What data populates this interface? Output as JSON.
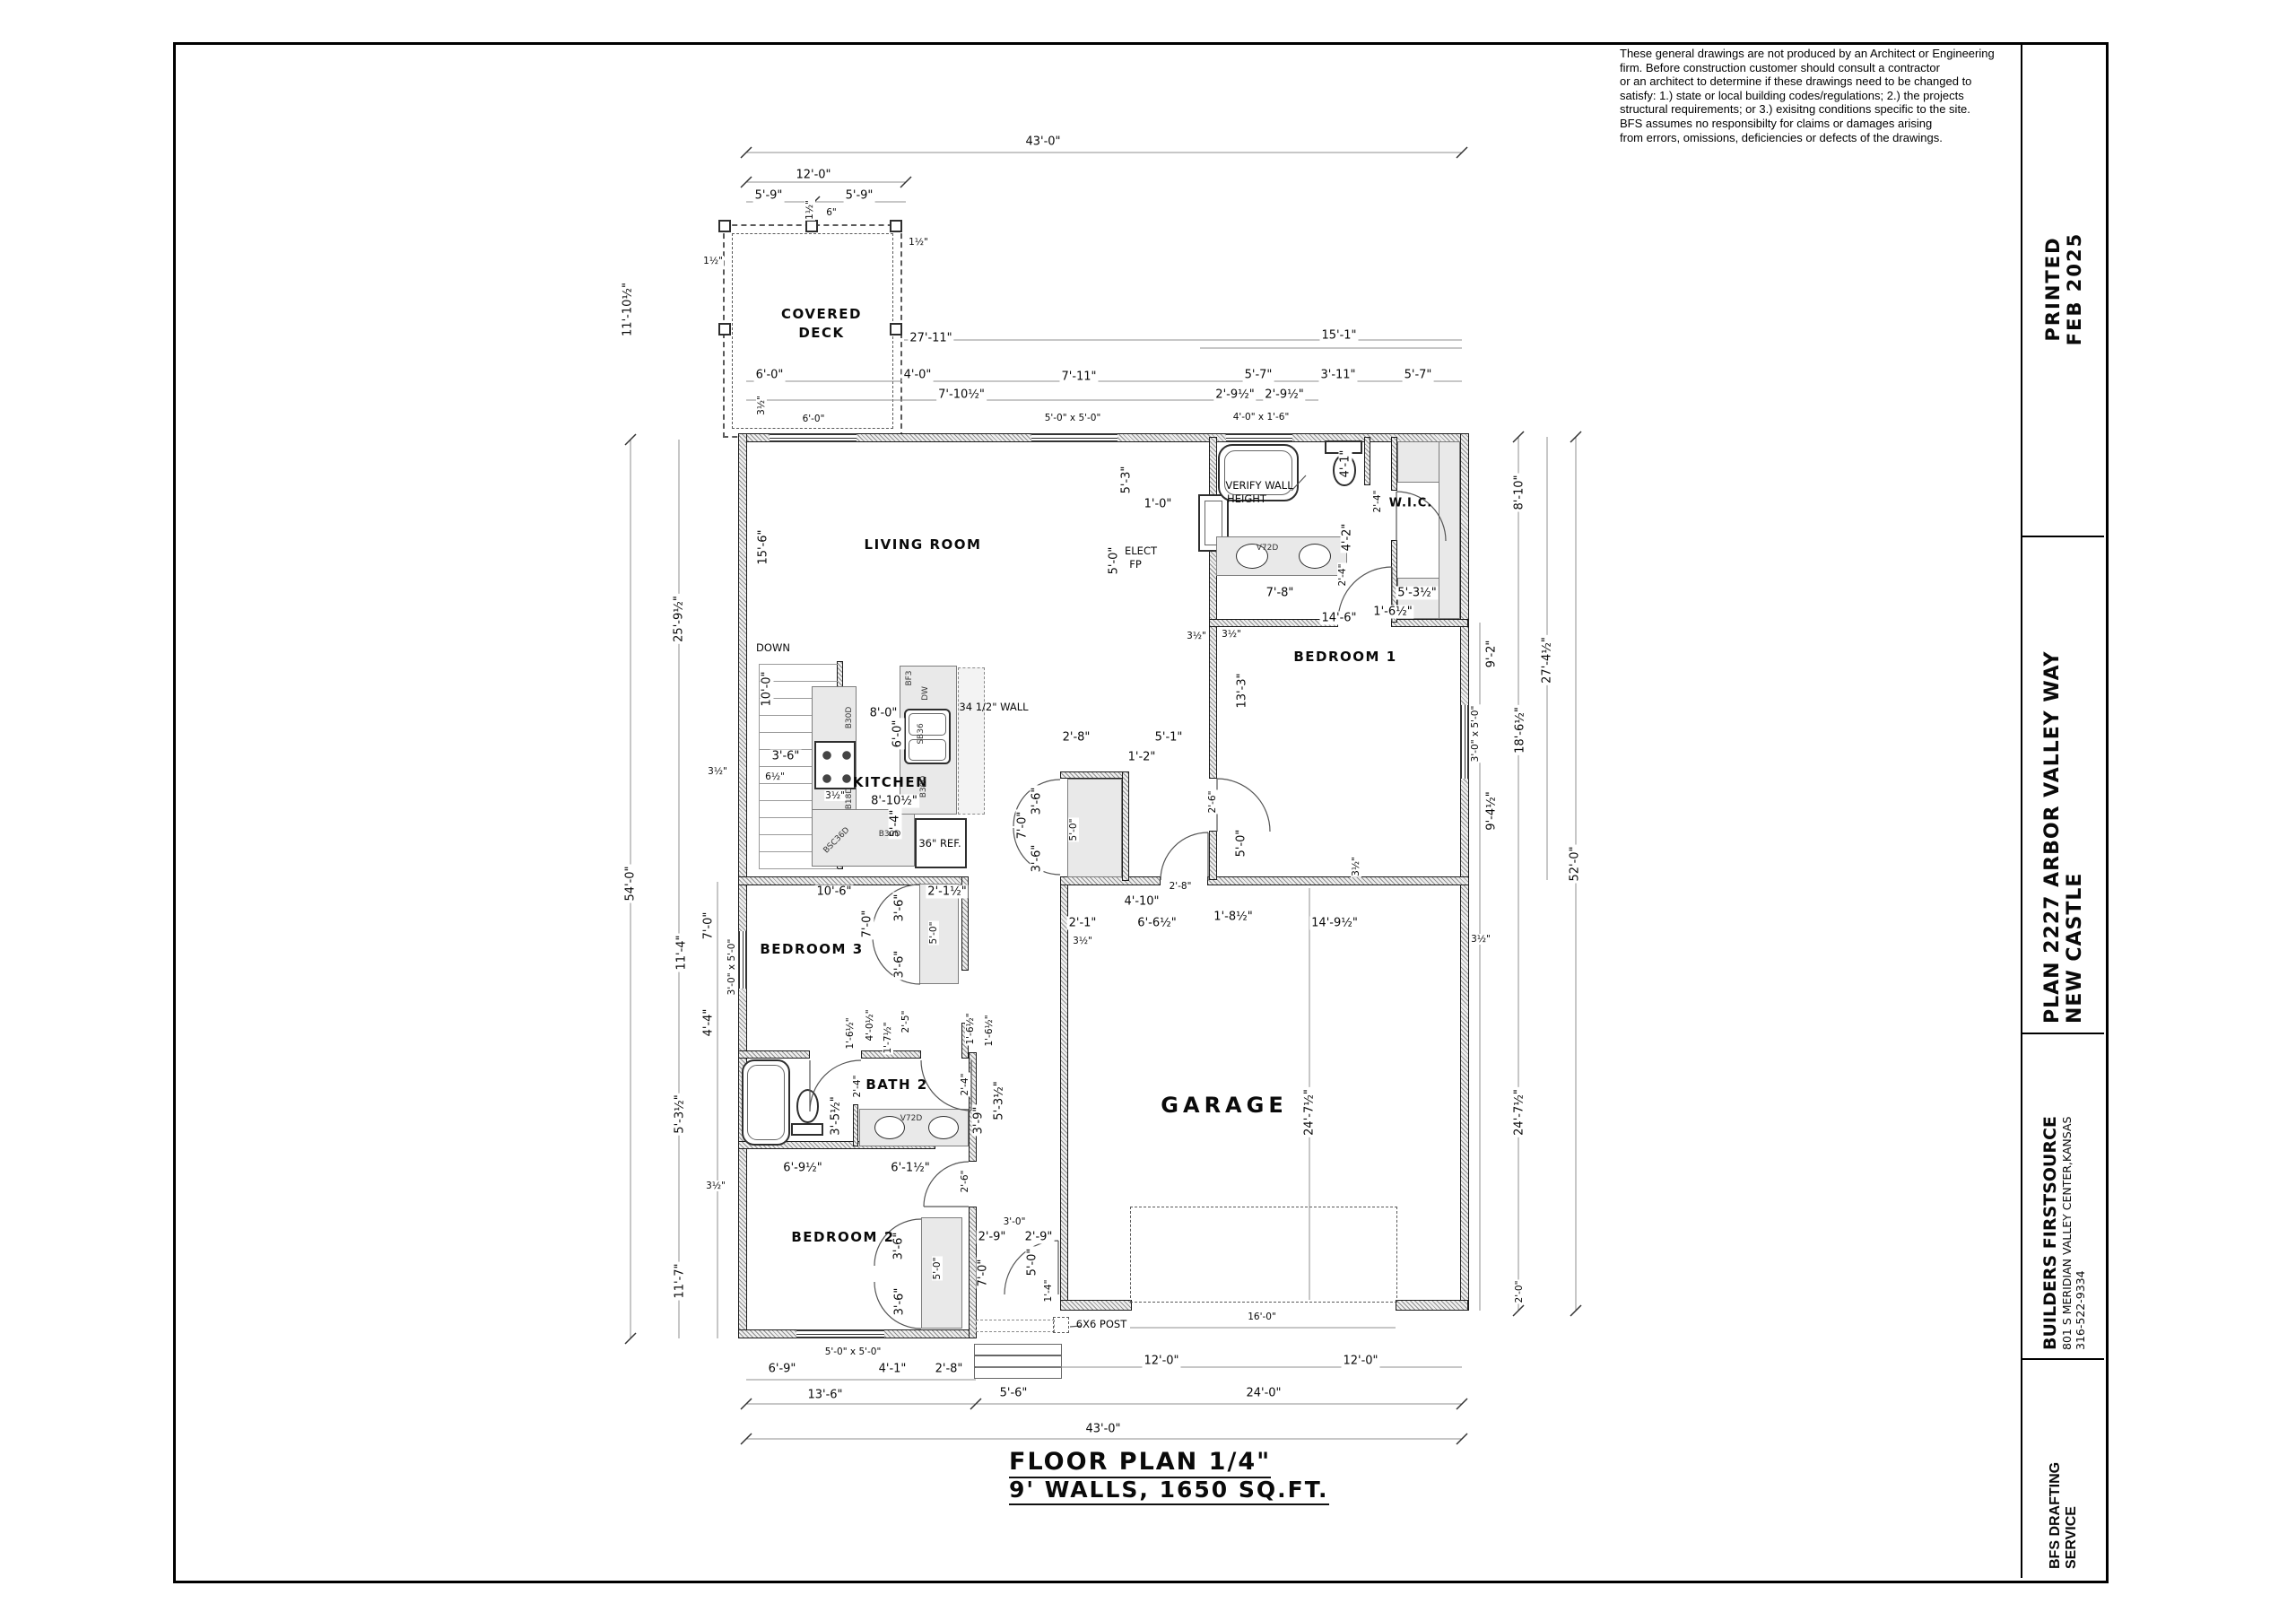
{
  "disclaimer": {
    "lines": [
      "These general drawings are not produced by an Architect or Engineering",
      "firm. Before construction customer should consult a contractor",
      "or an architect to determine if these drawings need to be changed to",
      "satisfy: 1.) state or local building codes/regulations; 2.) the projects",
      "structural requirements; or 3.) exisitng conditions specific to the site.",
      "BFS assumes no responsibilty for claims or damages arising",
      "from errors, omissions, deficiencies or defects of the drawings."
    ]
  },
  "title_block": {
    "printed": {
      "line1": "PRINTED",
      "line2": "FEB 2025"
    },
    "plan": {
      "line1": "PLAN 2227 ARBOR VALLEY WAY",
      "line2": "NEW CASTLE"
    },
    "company": {
      "line1": "BUILDERS FIRSTSOURCE",
      "line2": "801 S MERIDIAN VALLEY CENTER,KANSAS",
      "line3": "316-522-9334"
    },
    "service": {
      "line1": "BFS DRAFTING",
      "line2": "SERVICE"
    }
  },
  "plan_title": {
    "line1": "FLOOR PLAN 1/4\"",
    "line2": "9' WALLS, 1650 SQ.FT."
  },
  "plan": {
    "labels": [
      "43'-0\"",
      "12'-0\"",
      "5'-9\"",
      "5'-9\"",
      "1½\"",
      "6\"",
      "1½\"",
      "1½\"",
      "11'-10½\"",
      "27'-11\"",
      "6'-0\"",
      "4'-0\"",
      "7'-11\"",
      "7'-10½\"",
      "3½\"",
      "6'-0\"",
      "5'-0\" x 5'-0\"",
      "15'-1\"",
      "5'-7\"",
      "3'-11\"",
      "5'-7\"",
      "2'-9½\"",
      "2'-9½\"",
      "4'-0\" x 1'-6\"",
      "54'-0\"",
      "25'-9½\"",
      "15'-6\"",
      "11'-4\"",
      "7'-0\"",
      "3'-0\" x 5'-0\"",
      "4'-4\"",
      "5'-3½\"",
      "3½\"",
      "11'-7\"",
      "DOWN",
      "10'-0\"",
      "3'-6\"",
      "6½\"",
      "3½\"",
      "8'-0\"",
      "6'-0\"",
      "34 1/2\" WALL",
      "KITCHEN",
      "3½\"",
      "8'-10½\"",
      "5'-4\"",
      "36\" REF.",
      "B30D",
      "B18D",
      "BSC36D",
      "B30D",
      "BF3",
      "DW",
      "SB36",
      "B30D",
      "LIVING ROOM",
      "5'-3\"",
      "1'-0\"",
      "5'-0\"",
      "ELECT",
      "FP",
      "3½\"",
      "2'-8\"",
      "5'-1\"",
      "1'-2\"",
      "10'-6\"",
      "2'-1½\"",
      "7'-0\"",
      "3'-6\"",
      "3'-6\"",
      "5'-0\"",
      "BEDROOM 3",
      "7'-0\"",
      "3'-6\"",
      "3'-6\"",
      "5'-0\"",
      "2'-6\"",
      "5'-0\"",
      "3½\"",
      "2'-8\"",
      "4'-10\"",
      "1'-8½\"",
      "2'-1\"",
      "6'-6½\"",
      "14'-9½\"",
      "3½\"",
      "3½\"",
      "7'-8\"",
      "5'-3½\"",
      "1'-6½\"",
      "14'-6\"",
      "3½\"",
      "BEDROOM 1",
      "13'-3\"",
      "9'-2\"",
      "27'-4½\"",
      "3'-0\" x 5'-0\"",
      "18'-6½\"",
      "9'-4½\"",
      "52'-0\"",
      "VERIFY WALL",
      "HEIGHT",
      "4'-1\"",
      "2'-4\"",
      "W.I.C.",
      "4'-2\"",
      "2'-4\"",
      "V72D",
      "8'-10\"",
      "GARAGE",
      "24'-7½\"",
      "24'-7½\"",
      "16'-0\"",
      "6X6 POST",
      "12'-0\"",
      "12'-0\"",
      "2'-0\"",
      "BATH 2",
      "2'-4\"",
      "2'-4\"",
      "3'-5½\"",
      "V72D",
      "3'-9\"",
      "5'-3½\"",
      "1'-6½\"",
      "4'-0½\"",
      "1'-7½\"",
      "2'-5\"",
      "1'-6½\"",
      "1'-6½\"",
      "6'-9½\"",
      "6'-1½\"",
      "2'-6\"",
      "BEDROOM 2",
      "3'-6\"",
      "3'-6\"",
      "5'-0\"",
      "7'-0\"",
      "3'-0\"",
      "2'-9\"",
      "2'-9\"",
      "5'-0\"",
      "1'-4\"",
      "5'-0\" x 5'-0\"",
      "6'-9\"",
      "4'-1\"",
      "2'-8\"",
      "13'-6\"",
      "5'-6\"",
      "24'-0\"",
      "43'-0\"",
      "COVERED",
      "DECK"
    ]
  }
}
